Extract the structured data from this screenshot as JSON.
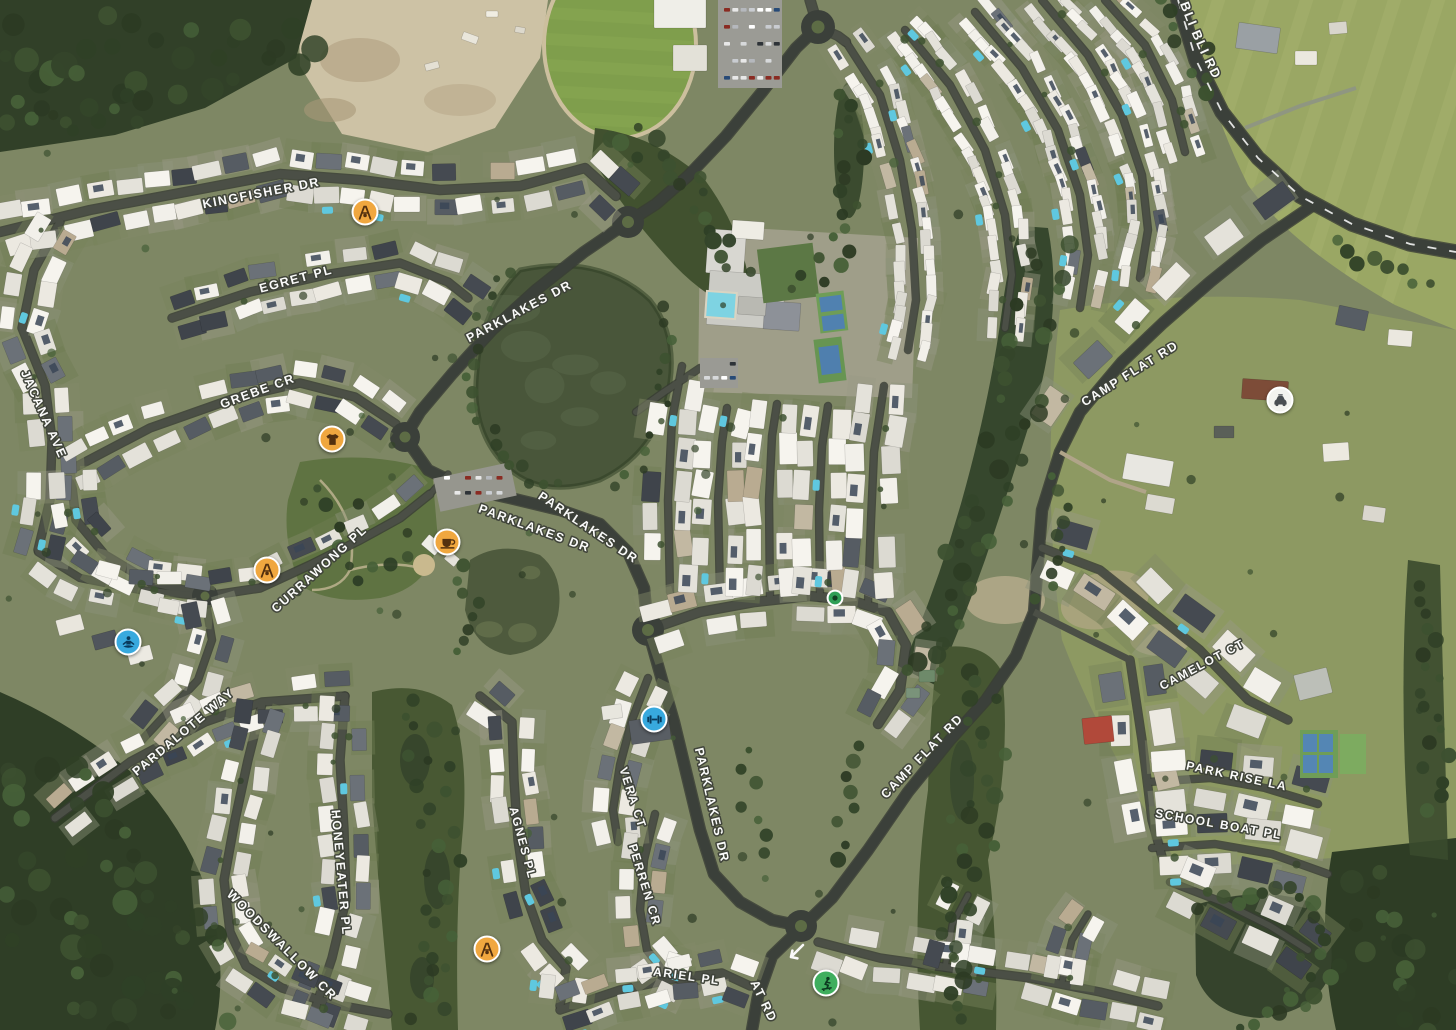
{
  "map": {
    "view_type": "satellite"
  },
  "colors": {
    "poi_orange": "#f0a73f",
    "poi_blue": "#38a9de",
    "poi_green": "#3fae5e",
    "poi_white": "#f3f3ef",
    "glyph_on_orange": "#53300f",
    "glyph_on_blue": "#093a5c",
    "glyph_on_green": "#0c3a20",
    "glyph_on_white": "#4a4e53",
    "transit_dot_green": "#2f9e56",
    "transit_dot_center": "#123f23",
    "label_fill": "#ffffff",
    "label_halo": "#3e4239"
  },
  "road_labels": [
    {
      "text": "KINGFISHER DR",
      "x": 262,
      "y": 197,
      "rot": -11,
      "size": 12.5
    },
    {
      "text": "EGRET PL",
      "x": 297,
      "y": 283,
      "rot": -15,
      "size": 12.5
    },
    {
      "text": "PARKLAKES DR",
      "x": 521,
      "y": 315,
      "rot": -28,
      "size": 12.5
    },
    {
      "text": "JACANA AVE",
      "x": 40,
      "y": 416,
      "rot": 66,
      "size": 12.5
    },
    {
      "text": "GREBE CR",
      "x": 259,
      "y": 395,
      "rot": -20,
      "size": 12.5
    },
    {
      "text": "CURRAWONG PL",
      "x": 322,
      "y": 572,
      "rot": -42,
      "size": 12.5
    },
    {
      "text": "PARDALOTE WAY",
      "x": 186,
      "y": 735,
      "rot": -40,
      "size": 12.5
    },
    {
      "text": "HONEYEATER PL",
      "x": 337,
      "y": 873,
      "rot": 85,
      "size": 12.5
    },
    {
      "text": "WOODSWALLOW CR",
      "x": 279,
      "y": 948,
      "rot": 45,
      "size": 12.5
    },
    {
      "text": "VERA CT",
      "x": 629,
      "y": 799,
      "rot": 72,
      "size": 12
    },
    {
      "text": "AGNES PL",
      "x": 519,
      "y": 844,
      "rot": 75,
      "size": 12
    },
    {
      "text": "PERREN CR",
      "x": 641,
      "y": 886,
      "rot": 73,
      "size": 12
    },
    {
      "text": "ARIEL PL",
      "x": 686,
      "y": 980,
      "rot": 8,
      "size": 12
    },
    {
      "text": "PARKLAKES DR",
      "x": 533,
      "y": 532,
      "rot": 20,
      "size": 12.5
    },
    {
      "text": "PARKLAKES DR",
      "x": 586,
      "y": 531,
      "rot": 34,
      "size": 12.5
    },
    {
      "text": "PARKLAKES DR",
      "x": 708,
      "y": 806,
      "rot": 77,
      "size": 12.5
    },
    {
      "text": "CAMP FLAT RD",
      "x": 1132,
      "y": 377,
      "rot": -32,
      "size": 12.5
    },
    {
      "text": "CAMP FLAT RD",
      "x": 925,
      "y": 759,
      "rot": -46,
      "size": 12.5
    },
    {
      "text": "AT RD",
      "x": 760,
      "y": 1003,
      "rot": 64,
      "size": 12.5
    },
    {
      "text": "CAMELOT CT",
      "x": 1204,
      "y": 668,
      "rot": -28,
      "size": 12
    },
    {
      "text": "PARK RISE LA",
      "x": 1236,
      "y": 780,
      "rot": 12,
      "size": 12
    },
    {
      "text": "SCHOOL BOAT PL",
      "x": 1218,
      "y": 828,
      "rot": 10,
      "size": 12
    },
    {
      "text": "YANDINA-BLI BLI RD",
      "curved": true,
      "size": 13
    }
  ],
  "poi_markers": [
    {
      "kind": "playground",
      "x": 365,
      "y": 212,
      "palette": "orange"
    },
    {
      "kind": "clothing",
      "x": 332,
      "y": 439,
      "palette": "orange"
    },
    {
      "kind": "cafe",
      "x": 447,
      "y": 542,
      "palette": "orange"
    },
    {
      "kind": "playground",
      "x": 267,
      "y": 570,
      "palette": "orange"
    },
    {
      "kind": "yoga",
      "x": 128,
      "y": 642,
      "palette": "blue"
    },
    {
      "kind": "fitness",
      "x": 654,
      "y": 719,
      "palette": "blue"
    },
    {
      "kind": "transit-dot",
      "x": 835,
      "y": 598,
      "palette": "green-dot"
    },
    {
      "kind": "car",
      "x": 1280,
      "y": 400,
      "palette": "white"
    },
    {
      "kind": "skate",
      "x": 826,
      "y": 983,
      "palette": "green"
    },
    {
      "kind": "playground",
      "x": 487,
      "y": 949,
      "palette": "orange"
    }
  ],
  "road_markings": [
    {
      "kind": "one-way-arrow",
      "x": 796,
      "y": 952
    }
  ]
}
